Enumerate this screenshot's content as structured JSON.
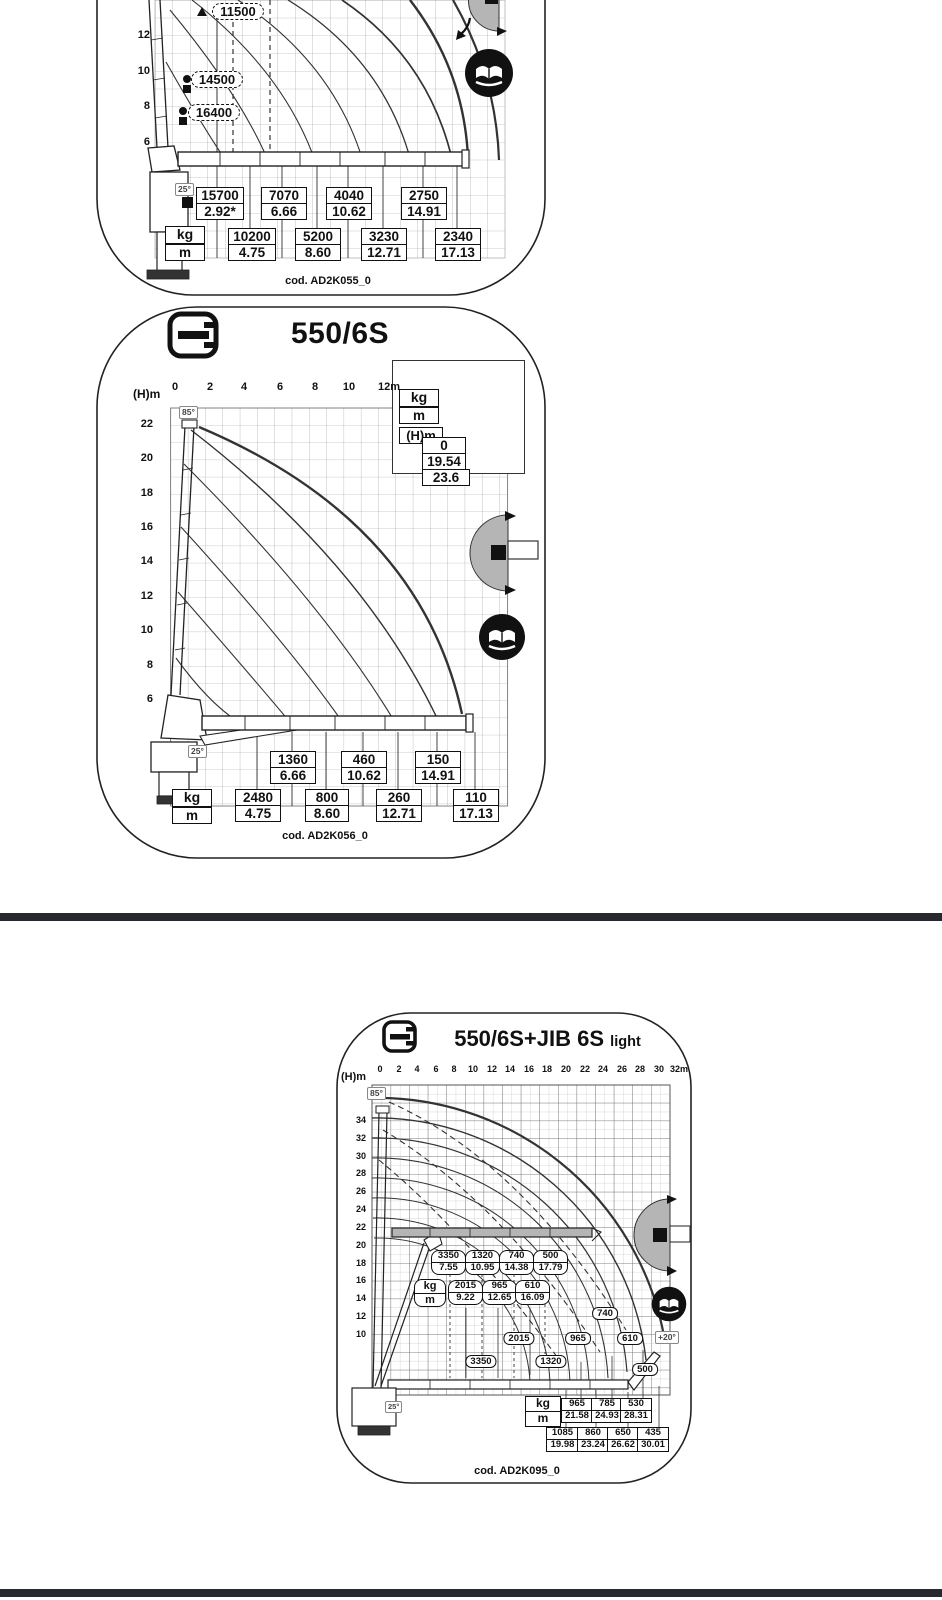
{
  "page": {
    "bg": "#ffffff",
    "divider_color": "#26282d",
    "ink": "#111111",
    "gray_fill": "#b5b5b5"
  },
  "panel_top": {
    "code": "cod. AD2K055_0",
    "y_ticks": [
      "14",
      "12",
      "10",
      "8",
      "6"
    ],
    "angle_boom": "25°",
    "hook_labels": [
      {
        "value": "11500"
      },
      {
        "value": "14500"
      },
      {
        "value": "16400"
      }
    ],
    "unit": {
      "top": "kg",
      "bottom": "m"
    },
    "row1": [
      {
        "load": "15700",
        "reach": "2.92*"
      },
      {
        "load": "7070",
        "reach": "6.66"
      },
      {
        "load": "4040",
        "reach": "10.62"
      },
      {
        "load": "2750",
        "reach": "14.91"
      }
    ],
    "row2": [
      {
        "load": "10200",
        "reach": "4.75"
      },
      {
        "load": "5200",
        "reach": "8.60"
      },
      {
        "load": "3230",
        "reach": "12.71"
      },
      {
        "load": "2340",
        "reach": "17.13"
      }
    ]
  },
  "panel_mid": {
    "title": "550/6S",
    "code": "cod. AD2K056_0",
    "axis_y_label": "(H)m",
    "x_ticks": [
      "0",
      "2",
      "4",
      "6",
      "8",
      "10",
      "12m"
    ],
    "y_ticks": [
      "22",
      "20",
      "18",
      "16",
      "14",
      "12",
      "10",
      "8",
      "6"
    ],
    "angle_max": "85°",
    "angle_boom": "25°",
    "legend": {
      "unit_top": "kg",
      "unit_bottom": "m",
      "hm_label": "(H)m",
      "load_at_max": "0",
      "max_reach": "19.54",
      "max_height": "23.6"
    },
    "unit": {
      "top": "kg",
      "bottom": "m"
    },
    "row1": [
      {
        "load": "1360",
        "reach": "6.66"
      },
      {
        "load": "460",
        "reach": "10.62"
      },
      {
        "load": "150",
        "reach": "14.91"
      }
    ],
    "row2": [
      {
        "load": "2480",
        "reach": "4.75"
      },
      {
        "load": "800",
        "reach": "8.60"
      },
      {
        "load": "260",
        "reach": "12.71"
      },
      {
        "load": "110",
        "reach": "17.13"
      }
    ]
  },
  "panel_jib": {
    "title": "550/6S+JIB 6S",
    "title_suffix": "light",
    "code": "cod. AD2K095_0",
    "axis_y_label": "(H)m",
    "x_ticks": [
      "0",
      "2",
      "4",
      "6",
      "8",
      "10",
      "12",
      "14",
      "16",
      "18",
      "20",
      "22",
      "24",
      "26",
      "28",
      "30",
      "32m"
    ],
    "y_ticks": [
      "34",
      "32",
      "30",
      "28",
      "26",
      "24",
      "22",
      "20",
      "18",
      "16",
      "14",
      "12",
      "10"
    ],
    "angle_max": "85°",
    "angle_boom": "25°",
    "angle_jib": "+20°",
    "unit": {
      "top": "kg",
      "bottom": "m"
    },
    "bubbles_row1": [
      {
        "load": "3350",
        "reach": "7.55"
      },
      {
        "load": "1320",
        "reach": "10.95"
      },
      {
        "load": "740",
        "reach": "14.38"
      },
      {
        "load": "500",
        "reach": "17.79"
      }
    ],
    "bubbles_row2": [
      {
        "load": "2015",
        "reach": "9.22"
      },
      {
        "load": "965",
        "reach": "12.65"
      },
      {
        "load": "610",
        "reach": "16.09"
      }
    ],
    "curve_tags": [
      "740",
      "2015",
      "965",
      "610",
      "3350",
      "1320",
      "500"
    ],
    "unit2": {
      "top": "kg",
      "bottom": "m"
    },
    "row1": [
      {
        "load": "965",
        "reach": "21.58"
      },
      {
        "load": "785",
        "reach": "24.93"
      },
      {
        "load": "530",
        "reach": "28.31"
      }
    ],
    "row2": [
      {
        "load": "1085",
        "reach": "19.98"
      },
      {
        "load": "860",
        "reach": "23.24"
      },
      {
        "load": "650",
        "reach": "26.62"
      },
      {
        "load": "435",
        "reach": "30.01"
      }
    ]
  },
  "chart_data": [
    {
      "type": "line",
      "title": "load chart (top, partially cropped)",
      "code": "AD2K055_0",
      "ylabel": "(H)m",
      "boom_angle_min_deg": 25,
      "winch_loads_kg": [
        11500,
        14500,
        16400
      ],
      "load_reach_row1": [
        [
          2.92,
          15700
        ],
        [
          6.66,
          7070
        ],
        [
          10.62,
          4040
        ],
        [
          14.91,
          2750
        ]
      ],
      "load_reach_row2": [
        [
          4.75,
          10200
        ],
        [
          8.6,
          5200
        ],
        [
          12.71,
          3230
        ],
        [
          17.13,
          2340
        ]
      ]
    },
    {
      "type": "line",
      "title": "550/6S",
      "code": "AD2K056_0",
      "xlabel": "m",
      "ylabel": "(H)m",
      "x_range": [
        0,
        12
      ],
      "y_ticks": [
        22,
        20,
        18,
        16,
        14,
        12,
        10,
        8,
        6
      ],
      "max_boom_angle_deg": 85,
      "min_boom_angle_deg": 25,
      "load_at_max_reach_kg": 0,
      "max_reach_m": 19.54,
      "max_height_m": 23.6,
      "load_reach_row1": [
        [
          6.66,
          1360
        ],
        [
          10.62,
          460
        ],
        [
          14.91,
          150
        ]
      ],
      "load_reach_row2": [
        [
          4.75,
          2480
        ],
        [
          8.6,
          800
        ],
        [
          12.71,
          260
        ],
        [
          17.13,
          110
        ]
      ]
    },
    {
      "type": "line",
      "title": "550/6S+JIB 6S light",
      "code": "AD2K095_0",
      "xlabel": "m",
      "ylabel": "(H)m",
      "x_range": [
        0,
        32
      ],
      "y_ticks": [
        34,
        32,
        30,
        28,
        26,
        24,
        22,
        20,
        18,
        16,
        14,
        12,
        10
      ],
      "max_boom_angle_deg": 85,
      "min_boom_angle_deg": 25,
      "jib_angle_deg": 20,
      "load_reach_horizontal": [
        [
          7.55,
          3350
        ],
        [
          9.22,
          2015
        ],
        [
          10.95,
          1320
        ],
        [
          12.65,
          965
        ],
        [
          14.38,
          740
        ],
        [
          16.09,
          610
        ],
        [
          17.79,
          500
        ]
      ],
      "load_reach_jib_row1": [
        [
          21.58,
          965
        ],
        [
          24.93,
          785
        ],
        [
          28.31,
          530
        ]
      ],
      "load_reach_jib_row2": [
        [
          19.98,
          1085
        ],
        [
          23.24,
          860
        ],
        [
          26.62,
          650
        ],
        [
          30.01,
          435
        ]
      ]
    }
  ]
}
